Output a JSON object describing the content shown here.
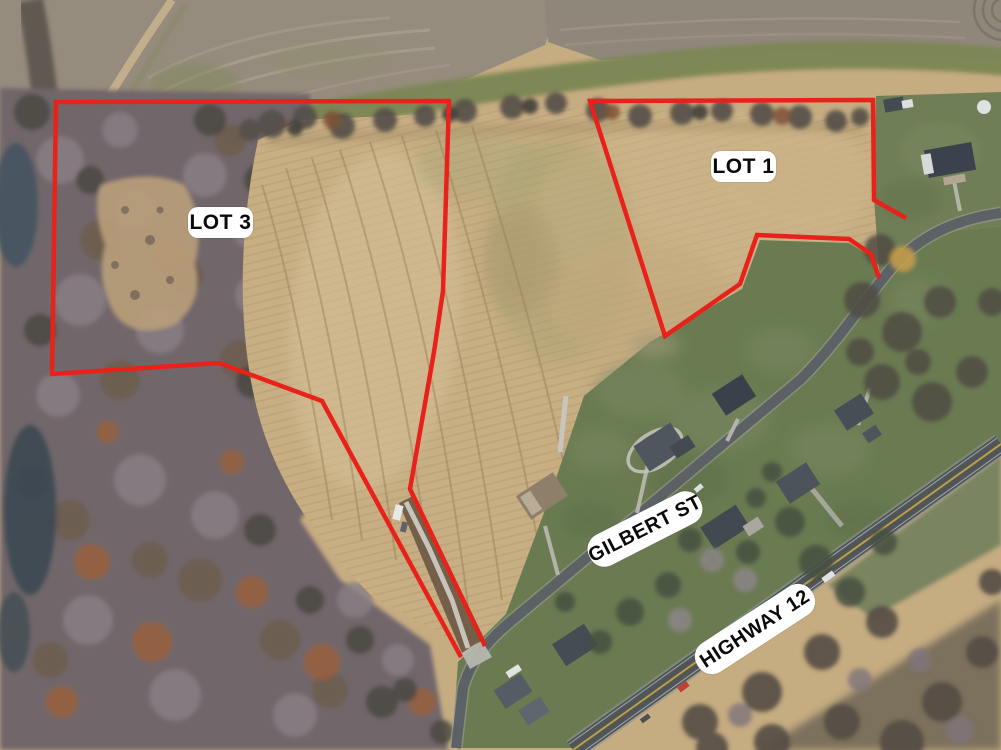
{
  "labels": {
    "lot3": "LOT 3",
    "lot1": "LOT 1",
    "gilbert_st": "GILBERT ST",
    "highway_12": "HIGHWAY 12"
  },
  "colors": {
    "boundary_red": "#e8211a",
    "label_background": "#ffffff",
    "label_text": "#0a0a0a"
  }
}
